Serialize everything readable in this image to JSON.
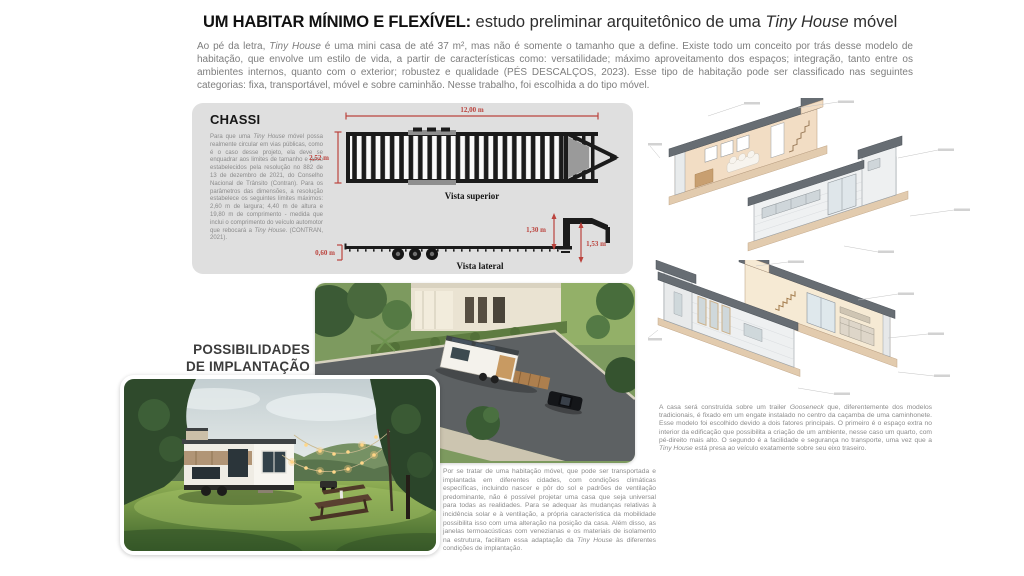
{
  "colors": {
    "dimension_red": "#bb433d",
    "panel_gray": "#dfdfdf",
    "body_text": "#8c8c8c",
    "heading_text": "#161616"
  },
  "header": {
    "title_bold": "UM HABITAR MÍNIMO E FLEXÍVEL:",
    "title_regular_1": " estudo preliminar arquitetônico de uma ",
    "title_italic": "Tiny House",
    "title_regular_2": " móvel",
    "intro_part1": "Ao pé da letra, ",
    "intro_italic": "Tiny House",
    "intro_part2": " é uma mini casa de até 37 m², mas não é somente o tamanho que a define. Existe todo um conceito por trás desse modelo de habitação, que envolve um estilo de vida, a partir de características como: versatilidade; máximo aproveitamento dos espaços; integração, tanto entre os ambientes internos, quanto com o exterior; robustez e qualidade (PÉS DESCALÇOS, 2023). Esse tipo de habitação pode ser classificado nas seguintes categorias: fixa, transportável, móvel e sobre caminhão. Nesse trabalho, foi escolhida a do tipo móvel."
  },
  "chassi": {
    "heading": "CHASSI",
    "body_part1": "Para que uma ",
    "body_italic1": "Tiny House",
    "body_part2": " móvel possa realmente circular em vias públicas, como é o caso desse projeto, ela deve se enquadrar aos limites de tamanho e peso estabelecidos pela resolução no 882 de 13 de dezembro de 2021, do Conselho Nacional de Trânsito (Contran). Para os parâmetros das dimensões, a resolução estabelece os seguintes limites máximos: 2,60 m de largura; 4,40 m de altura e 19,80 m de comprimento - medida que inclui o comprimento do veículo automotor que rebocará a ",
    "body_italic2": "Tiny House",
    "body_part3": ". (CONTRAN, 2021).",
    "dim_length": "12,00 m",
    "dim_width": "2,52 m",
    "dim_deck": "0,60 m",
    "dim_neck": "1,30 m",
    "dim_neck_total": "1,53 m",
    "label_top_view": "Vista superior",
    "label_side_view": "Vista lateral"
  },
  "implantacao": {
    "heading": "POSSIBILIDADES\nDE IMPLANTAÇÃO",
    "body_part1": "Por se tratar de uma habitação móvel, que pode ser transportada e implantada em diferentes cidades, com condições climáticas específicas, incluindo nascer e pôr do sol e padrões de ventilação predominante, não é possível projetar uma casa que seja universal para todas as realidades. Para se adequar às mudanças relativas à incidência solar e à ventilação, a própria característica da mobilidade possibilita isso com uma alteração na posição da casa. Além disso, as janelas termoacústicas com venezianas e os materiais de isolamento na estrutura, facilitam essa adaptação da ",
    "body_italic": "Tiny House",
    "body_part2": " às diferentes condições de implantação."
  },
  "gooseneck": {
    "body_part1": "A casa será construída sobre um trailer ",
    "body_italic1": "Gooseneck",
    "body_part2": " que, diferentemente dos modelos tradicionais, é fixado em um engate instalado no centro da caçamba de uma caminhonete. Esse modelo foi escolhido devido a dois fatores principais. O primeiro é o espaço extra no interior da edificação que possibilita a criação de um ambiente, nesse caso um quarto, com pé-direito mais alto. O segundo é a facilidade e segurança no transporte, uma vez que a ",
    "body_italic2": "Tiny House",
    "body_part3": " está presa ao veículo exatamente sobre seu eixo traseiro."
  }
}
